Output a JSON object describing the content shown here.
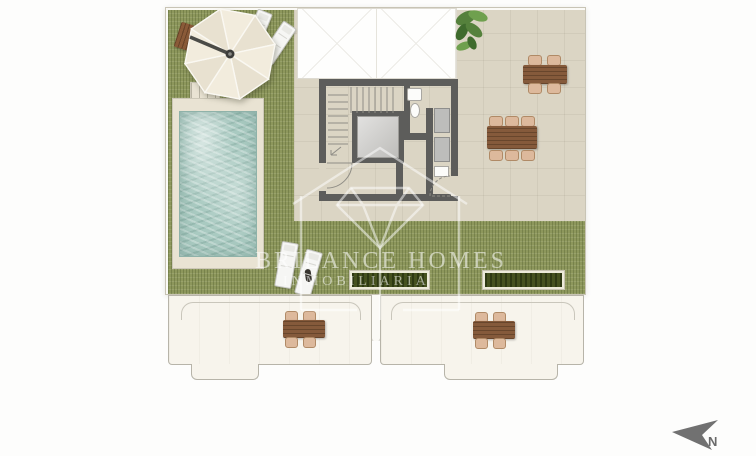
{
  "watermark": {
    "brand": "BRILANCE HOMES",
    "subtitle": "INMOBILIARIA"
  },
  "compass": {
    "label": "N"
  },
  "palette": {
    "background": "#fdfdfc",
    "grass": "#8d975c",
    "terrace_tile": "#dbd5c4",
    "pool_water": "#a9cac1",
    "pool_deck": "#e9e3d3",
    "wall": "#5d5d5b",
    "wood_table": "#855a3b",
    "chair": "#ddb99c",
    "hedge": "#45511f",
    "balcony": "#f7f4ec",
    "outline": "#b7b4a9",
    "umbrella": "#efe8d8",
    "plant": "#55813c",
    "north_arrow": "#717171",
    "watermark": "#ffffff"
  },
  "features": [
    "swimming-pool",
    "parasol",
    "sun-loungers",
    "outdoor-dining-tables",
    "hedge-planters",
    "staircase",
    "elevator",
    "bathroom",
    "lower-balconies"
  ]
}
